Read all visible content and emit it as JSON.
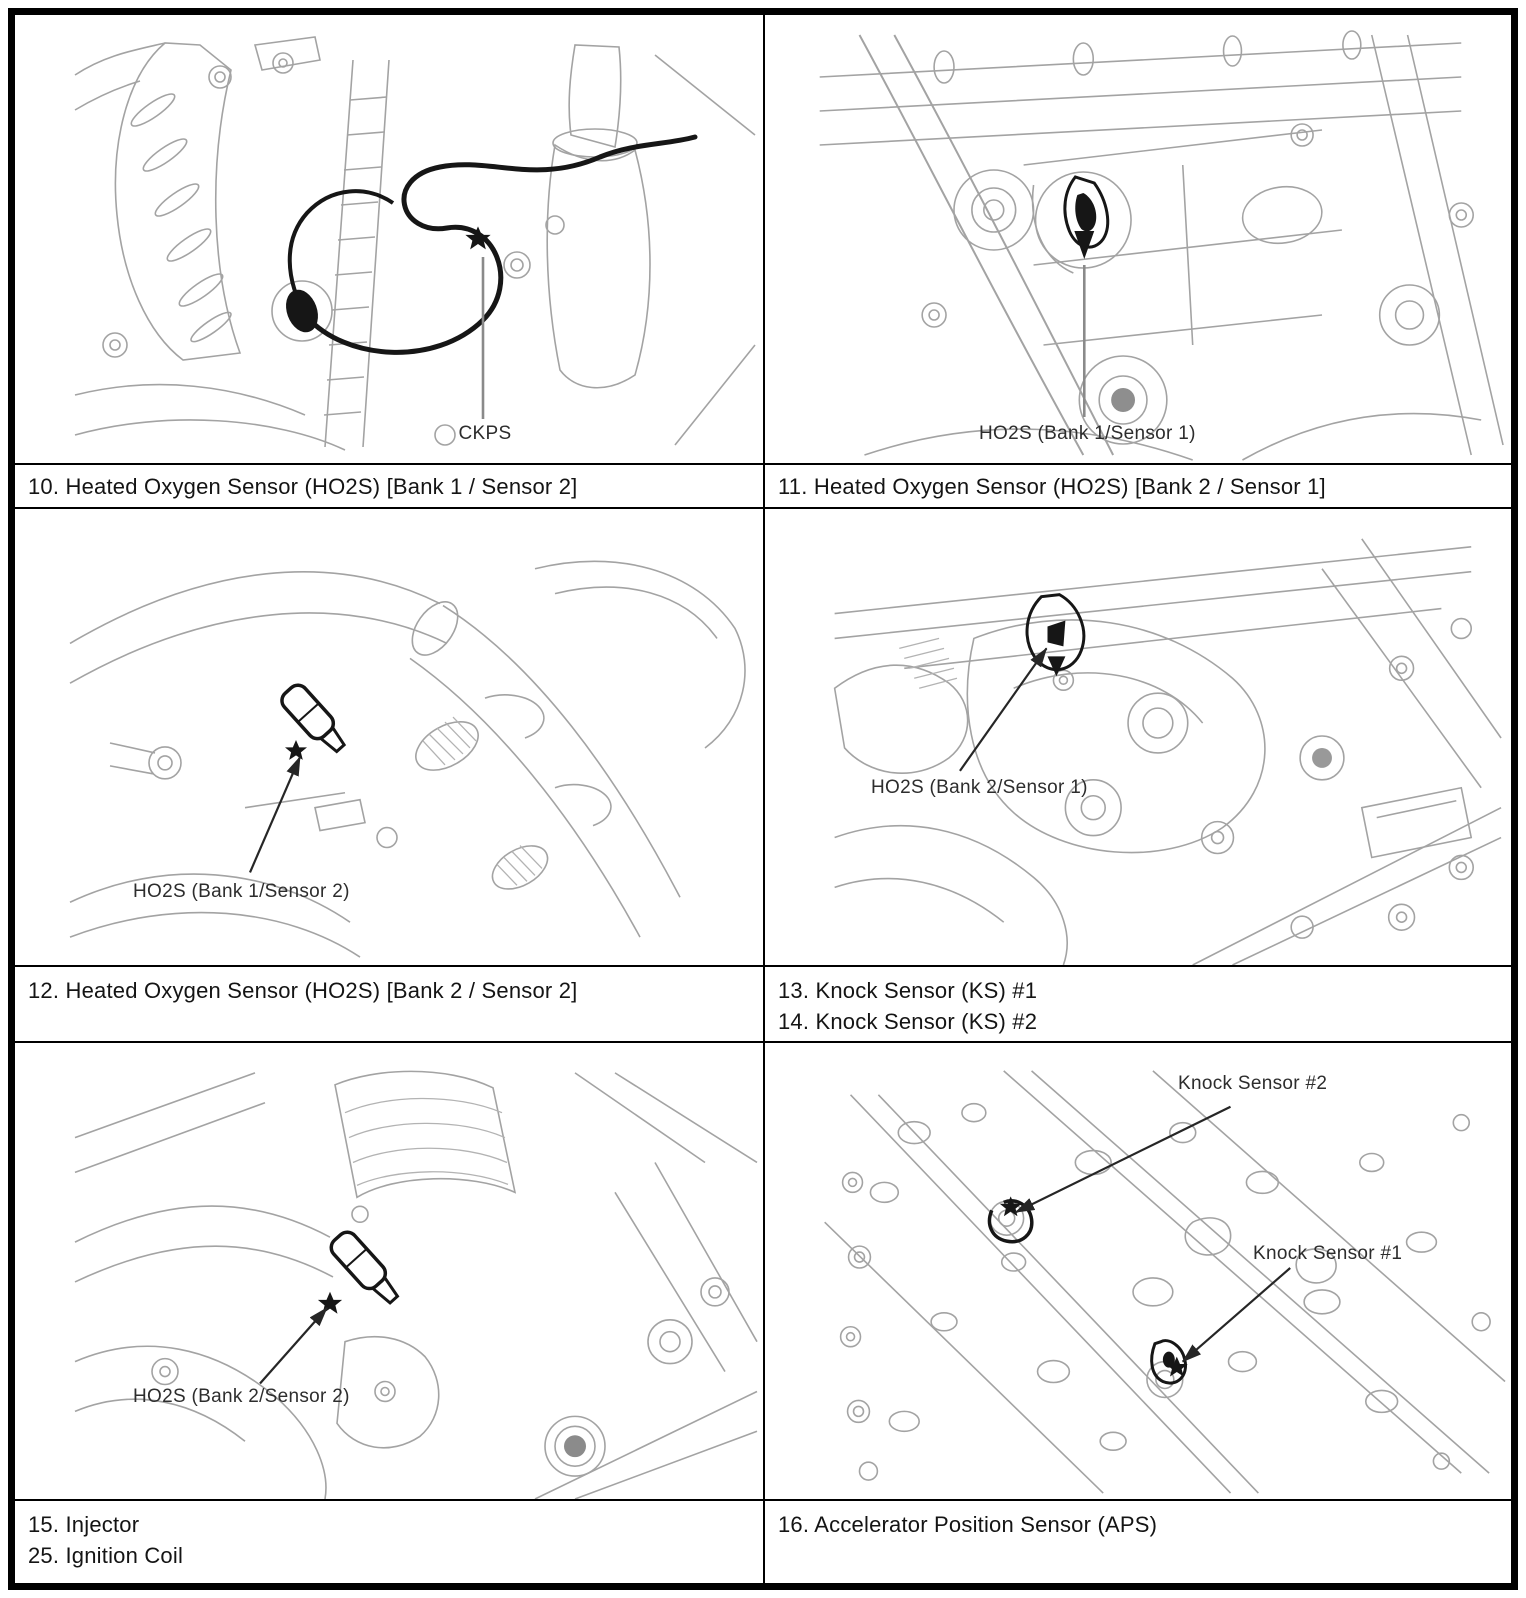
{
  "colors": {
    "background": "#ffffff",
    "table_border": "#000000",
    "sketch_line": "#a3a3a3",
    "dark_line": "#161616",
    "callout_text": "#2d2d2d",
    "caption_text": "#141414"
  },
  "callouts": {
    "ckps": "CKPS",
    "ho2s_b1s1": "HO2S (Bank 1/Sensor 1)",
    "ho2s_b1s2": "HO2S (Bank 1/Sensor 2)",
    "ho2s_b2s1": "HO2S (Bank 2/Sensor 1)",
    "ho2s_b2s2": "HO2S (Bank 2/Sensor 2)",
    "knock_sensor_2": "Knock Sensor #2",
    "knock_sensor_1": "Knock Sensor #1"
  },
  "captions": {
    "item_10": "10. Heated Oxygen Sensor (HO2S) [Bank 1 / Sensor 2]",
    "item_11": "11. Heated Oxygen Sensor (HO2S) [Bank 2 / Sensor 1]",
    "item_12": "12. Heated Oxygen Sensor (HO2S) [Bank 2 / Sensor 2]",
    "item_13": "13. Knock Sensor (KS) #1",
    "item_14": "14. Knock Sensor (KS) #2",
    "item_15": "15. Injector",
    "item_25": "25. Ignition Coil",
    "item_16": "16. Accelerator Position Sensor (APS)"
  }
}
